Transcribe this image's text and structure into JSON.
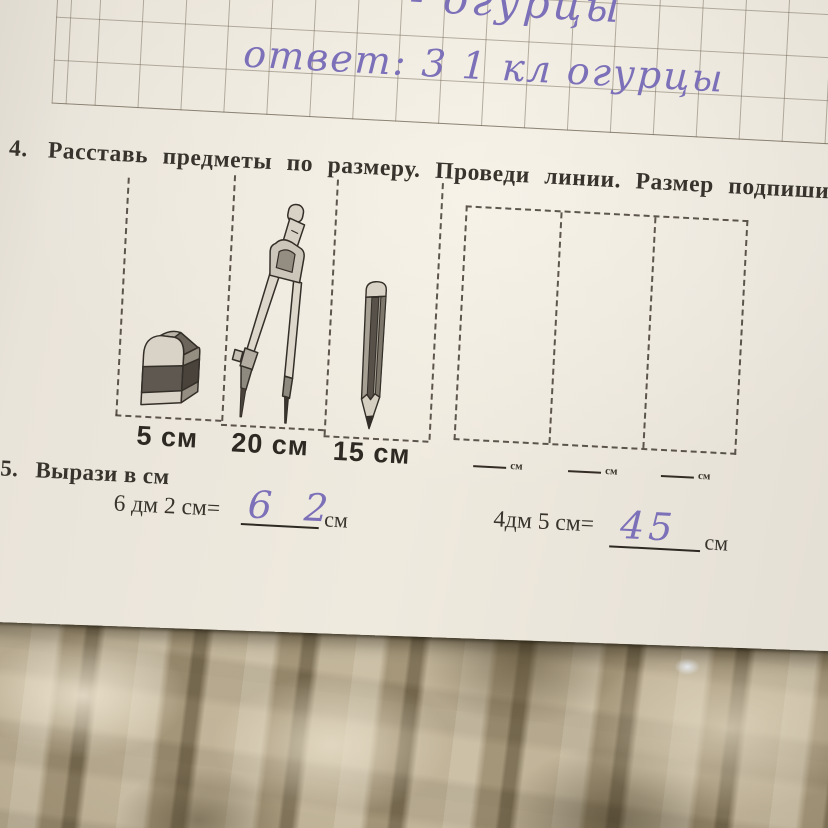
{
  "photo": {
    "notebook": {
      "handwriting_top": "- огурцы",
      "handwriting_answer": "ответ: 3 1 кл огурцы"
    },
    "task4": {
      "number": "4.",
      "instruction": "Расставь предметы по размеру. Проведи линии. Размер подпиши.",
      "items": [
        {
          "object": "eraser",
          "label": "5 см"
        },
        {
          "object": "compass",
          "label": "20 см"
        },
        {
          "object": "pencil",
          "label": "15 см"
        }
      ],
      "answer_slots": [
        {
          "unit": "см"
        },
        {
          "unit": "см"
        },
        {
          "unit": "см"
        }
      ]
    },
    "task5": {
      "number": "5.",
      "title": "Вырази в см",
      "conversions": [
        {
          "prompt": "6 дм 2 см=",
          "answer": "6 2",
          "unit": "см"
        },
        {
          "prompt": "4дм 5 см=",
          "answer": "45",
          "unit": "см"
        }
      ]
    },
    "colors": {
      "paper": "#eae5dc",
      "print_ink": "#38332c",
      "pen_ink": "#7c70b9",
      "grid_line": "#736958",
      "carpet_base": "#ab9d81"
    }
  }
}
